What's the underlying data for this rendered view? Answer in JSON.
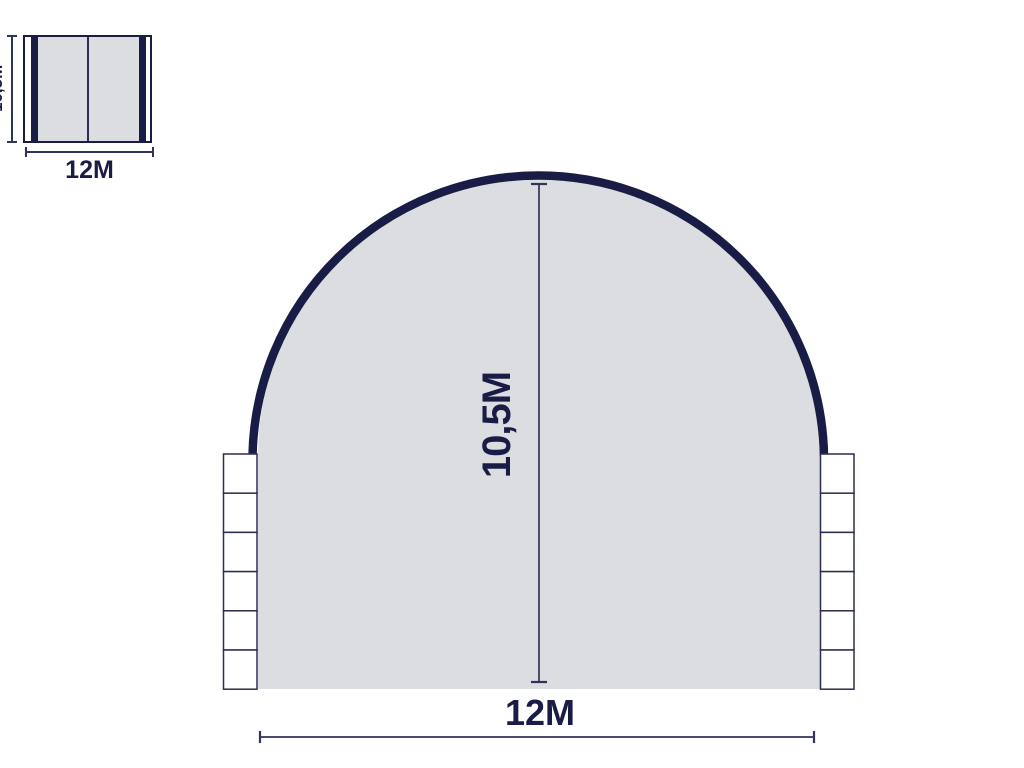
{
  "page": {
    "description": "Dimension diagram of an arched dome shelter: small plan view top-left and large front elevation"
  },
  "colors": {
    "navy": "#191d45",
    "panel_gray": "#dcdde0",
    "dimension_line": "#30335a",
    "background": "#ffffff"
  },
  "plan_view": {
    "width_label": "12M",
    "side_label": "10,5M"
  },
  "front_view": {
    "height_label": "10,5M",
    "width_label": "12M",
    "ballast_blocks_per_side": 6
  }
}
